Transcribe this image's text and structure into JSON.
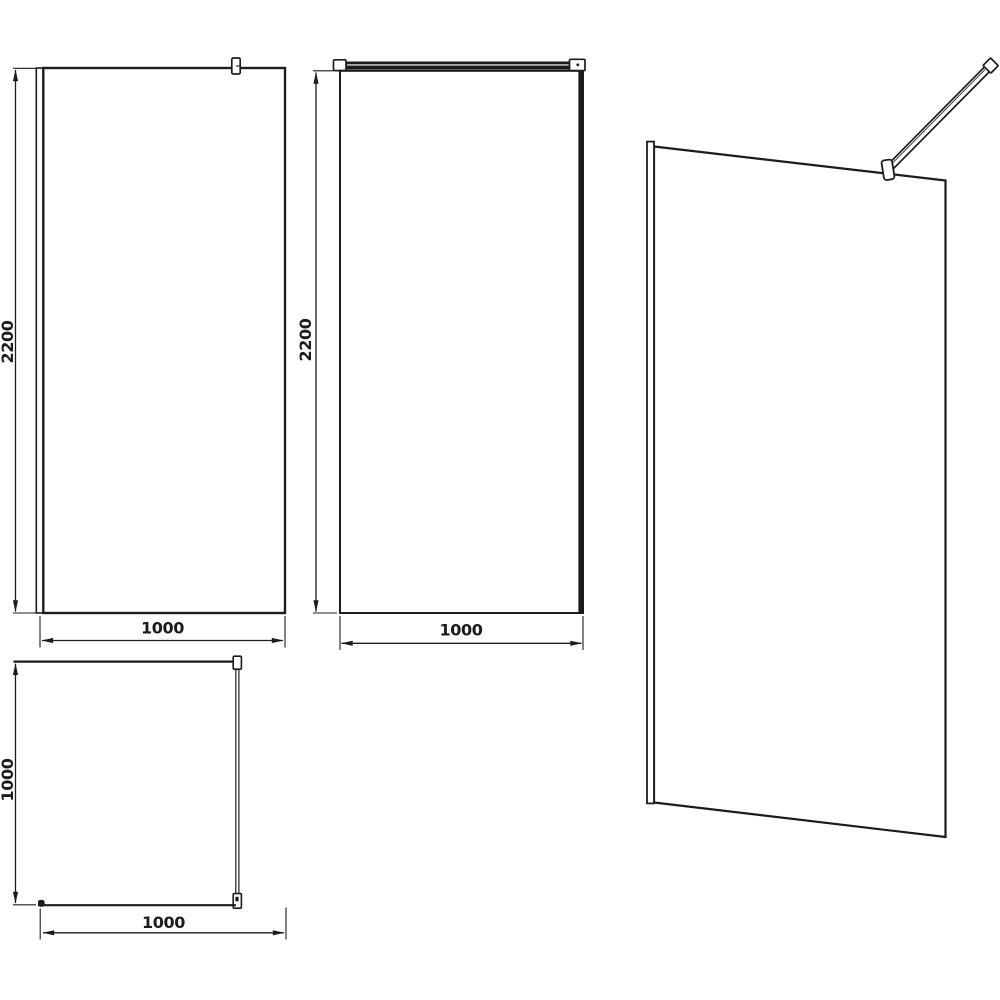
{
  "colors": {
    "line": "#1c1c1c",
    "background": "#ffffff"
  },
  "dimensions": {
    "front_view": {
      "height": "2200",
      "width": "1000"
    },
    "back_view": {
      "height": "2200",
      "width": "1000"
    },
    "plan_view": {
      "depth": "1000",
      "width": "1000"
    }
  }
}
